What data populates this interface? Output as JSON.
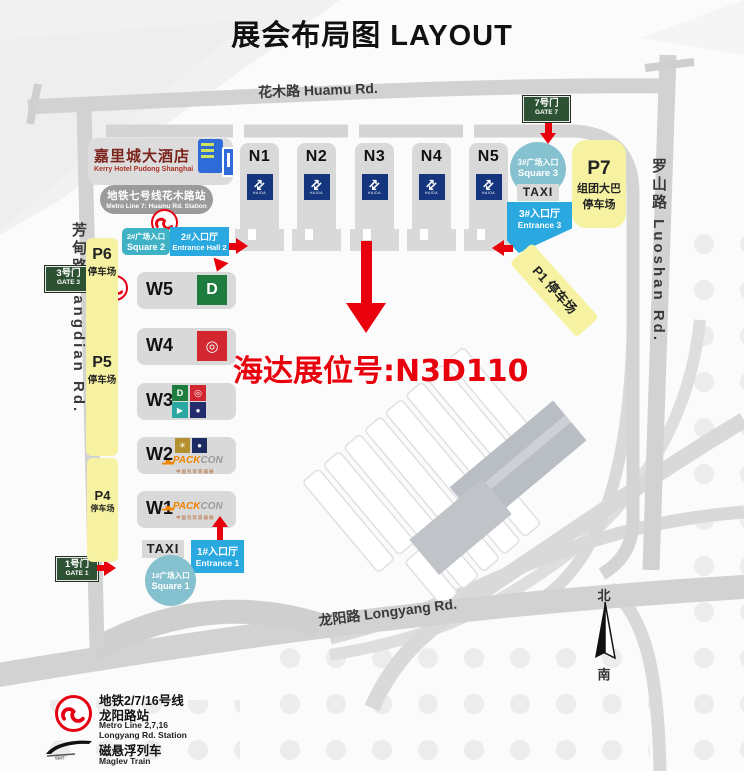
{
  "title": "展会布局图 LAYOUT",
  "roads": {
    "huamu": "花木路 Huamu Rd.",
    "luoshan": "罗山路  Luoshan Rd.",
    "fangdian": "芳甸路  Fangdian Rd.",
    "longyang": "龙阳路 Longyang Rd."
  },
  "hotel": {
    "name_cn": "嘉里城大酒店",
    "name_en": "Kerry Hotel Pudong Shanghai"
  },
  "metro_line7": {
    "line1": "地铁七号线花木路站",
    "line2": "Metro Line 7: Huamu Rd. Station"
  },
  "gates": {
    "gate7": {
      "cn": "7号门",
      "en": "GATE 7"
    },
    "gate3": {
      "cn": "3号门",
      "en": "GATE 3"
    },
    "gate1": {
      "cn": "1号门",
      "en": "GATE 1"
    }
  },
  "north_halls": {
    "labels": [
      "N1",
      "N2",
      "N3",
      "N4",
      "N5"
    ],
    "logo": {
      "name": "expo-arrows-logo",
      "glyph": "⇄",
      "text": "HAIDA",
      "color": "#15357e"
    }
  },
  "west_halls": {
    "w5": "W5",
    "w4": "W4",
    "w3": "W3",
    "w2": "W2",
    "w1": "W1"
  },
  "logos": {
    "green_d": {
      "glyph": "D",
      "color": "#1d7c3e"
    },
    "red_emblem": {
      "glyph": "◎",
      "color": "#d22730"
    },
    "teal_box": {
      "glyph": "▶",
      "color": "#2aa7a0"
    },
    "navy_dot": {
      "glyph": "●",
      "color": "#232d6e"
    },
    "gold_bulb": {
      "glyph": "☀",
      "color": "#b5902e"
    },
    "navy_round": {
      "glyph": "●",
      "color": "#1d2b63"
    },
    "packcon": {
      "skyline": "▂▅▃",
      "pack": "PACK",
      "con": "CON",
      "sub": "中国包装容器展"
    }
  },
  "entrances": {
    "square2": {
      "line1": "2#广场入口",
      "line2": "Square 2"
    },
    "hall2": {
      "line1": "2#入口厅",
      "line2": "Entrance Hall 2"
    },
    "square3": {
      "line1": "3#广场入口",
      "line2": "Square 3"
    },
    "entrance3": {
      "line1": "3#入口厅",
      "line2": "Entrance 3"
    },
    "square1": {
      "line1": "1#广场入口",
      "line2": "Square 1"
    },
    "entrance1": {
      "line1": "1#入口厅",
      "line2": "Entrance 1"
    }
  },
  "taxi_top": "TAXI",
  "taxi_bottom": "TAXI",
  "parking": {
    "p7": {
      "label": "P7",
      "line1": "组团大巴",
      "line2": "停车场"
    },
    "p6": {
      "label": "P6",
      "sub": "停车场"
    },
    "p5": {
      "label": "P5",
      "sub": "停车场"
    },
    "p4": {
      "label": "P4",
      "sub": "停车场"
    },
    "p1": {
      "label": "P1 停车场"
    }
  },
  "highlight": {
    "booth_text": "海达展位号:N3D110",
    "color": "#e8000d"
  },
  "compass": {
    "north": "北",
    "south": "南"
  },
  "legend": {
    "metro": {
      "line1": "地铁2/7/16号线",
      "line2": "龙阳路站",
      "line3": "Metro Line 2,7,16",
      "line4": "Longyang Rd. Station"
    },
    "maglev": {
      "line1": "磁悬浮列车",
      "line2": "Maglev Train",
      "smt": "SMT"
    }
  },
  "colors": {
    "red": "#e8000d",
    "entrance_blue": "#29a9e0",
    "square_teal": "#85c1ce",
    "label_teal": "#40b2c6",
    "parking_yellow": "#f6f2a2",
    "gate_green": "#2d5233",
    "hall_gray": "#d9d9d9",
    "logo_navy": "#15357e",
    "metro_red": "#e60012"
  }
}
